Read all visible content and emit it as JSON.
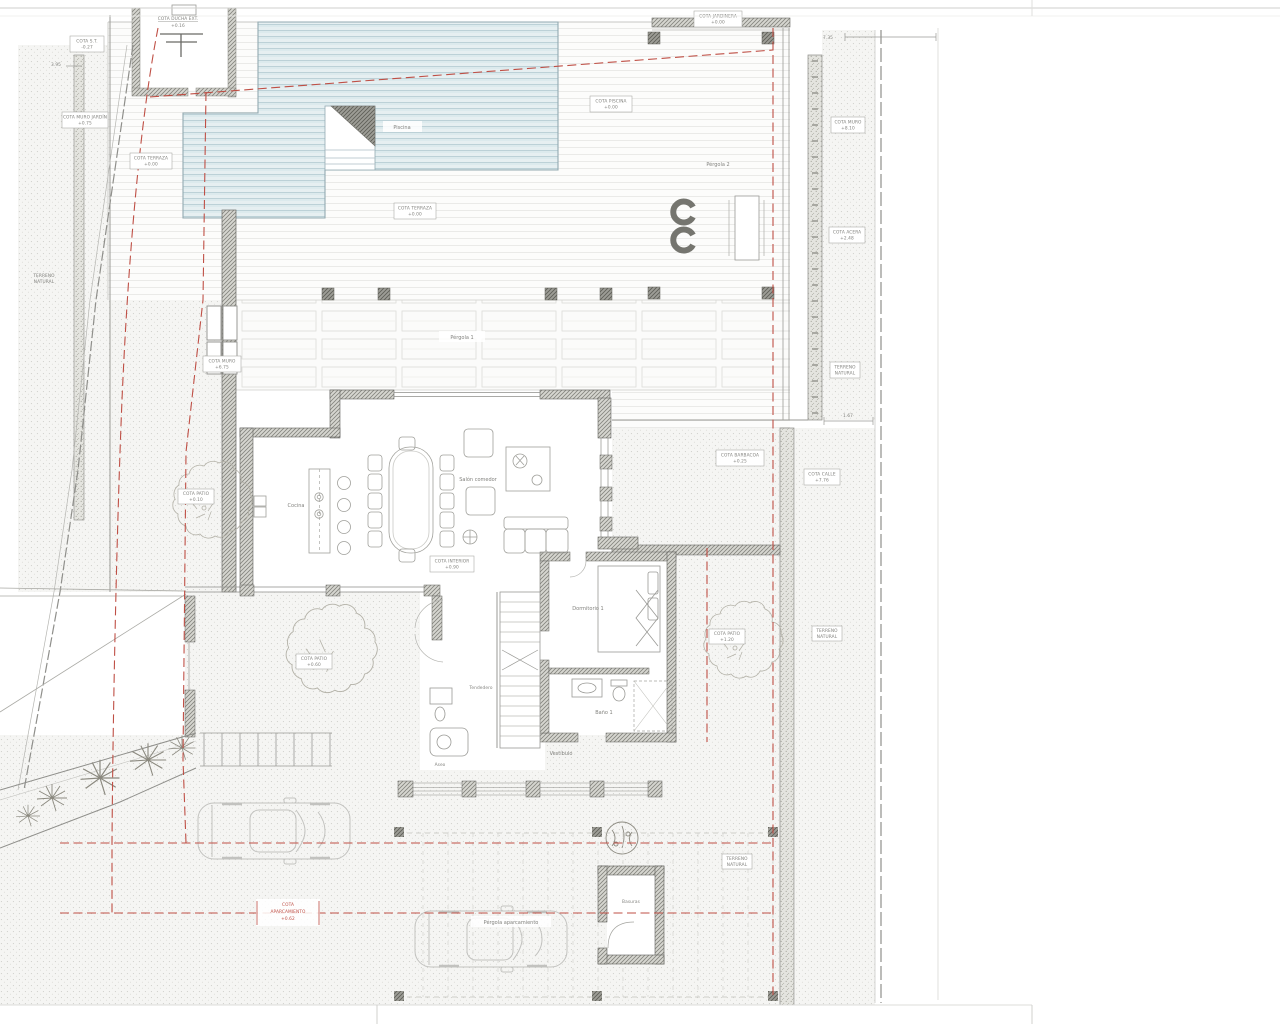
{
  "document": {
    "type": "architectural-site-plan",
    "floor": "planta baja"
  },
  "colors": {
    "background": "#ffffff",
    "setback_red": "#bf4f45",
    "wall_gray": "#84847e",
    "pool_blue": "#bcd2d9",
    "deck_line": "#e3e3e0",
    "terrain_dot": "#cdcdc8",
    "annotation_text": "#82827e",
    "car_outline": "#c2c2bf",
    "tree_outline": "#b4b2a8"
  },
  "labels": {
    "cota_st": {
      "name": "COTA S.T.",
      "value": "-0.27"
    },
    "cota_ducha": {
      "name": "COTA DUCHA EXT.",
      "value": "+0.16"
    },
    "cota_muro_jardin": {
      "name": "COTA MURO JARDÍN",
      "value": "+0.75"
    },
    "cota_terraza_a": {
      "name": "COTA TERRAZA",
      "value": "+0.00"
    },
    "cota_terraza_b": {
      "name": "COTA TERRAZA",
      "value": "+0.00"
    },
    "cota_piscina": {
      "name": "COTA PISCINA",
      "value": "+0.00"
    },
    "cota_jardinera": {
      "name": "COTA JARDINERA",
      "value": "+0.00"
    },
    "cota_muro": {
      "name": "COTA MURO",
      "value": "+6.75"
    },
    "cota_muro_alto": {
      "name": "COTA MURO",
      "value": "+8.10"
    },
    "cota_acera": {
      "name": "COTA ACERA",
      "value": "+2.48"
    },
    "cota_calle": {
      "name": "COTA CALLE",
      "value": "+7.76"
    },
    "cota_barbacoa": {
      "name": "COTA BARBACOA",
      "value": "+0.25"
    },
    "cota_interior": {
      "name": "COTA INTERIOR",
      "value": "+0.90"
    },
    "cota_patio_oeste": {
      "name": "COTA PATIO",
      "value": "+0.10"
    },
    "cota_patio_central": {
      "name": "COTA PATIO",
      "value": "+0.60"
    },
    "cota_patio_este": {
      "name": "COTA PATIO",
      "value": "+1.20"
    },
    "cota_aparcamiento": {
      "name1": "COTA",
      "name2": "APARCAMIENTO",
      "value": "+0.62"
    },
    "terreno_natural": {
      "line1": "TERRENO",
      "line2": "NATURAL"
    }
  },
  "rooms": {
    "piscina": "Piscina",
    "pergola_1": "Pérgola 1",
    "pergola_2": "Pérgola 2",
    "cocina": "Cocina",
    "salon_comedor": "Salón comedor",
    "dormitorio_1": "Dormitorio 1",
    "bano_1": "Baño 1",
    "tendedero": "Tendedero",
    "vestibulo": "Vestíbulo",
    "aseo": "Aseo",
    "basuras": "Basuras",
    "pergola_aparcamiento": "Pérgola aparcamiento"
  },
  "dimensions": {
    "acera": "7.35",
    "muro": "1.67",
    "retranqueo": "3.95"
  }
}
